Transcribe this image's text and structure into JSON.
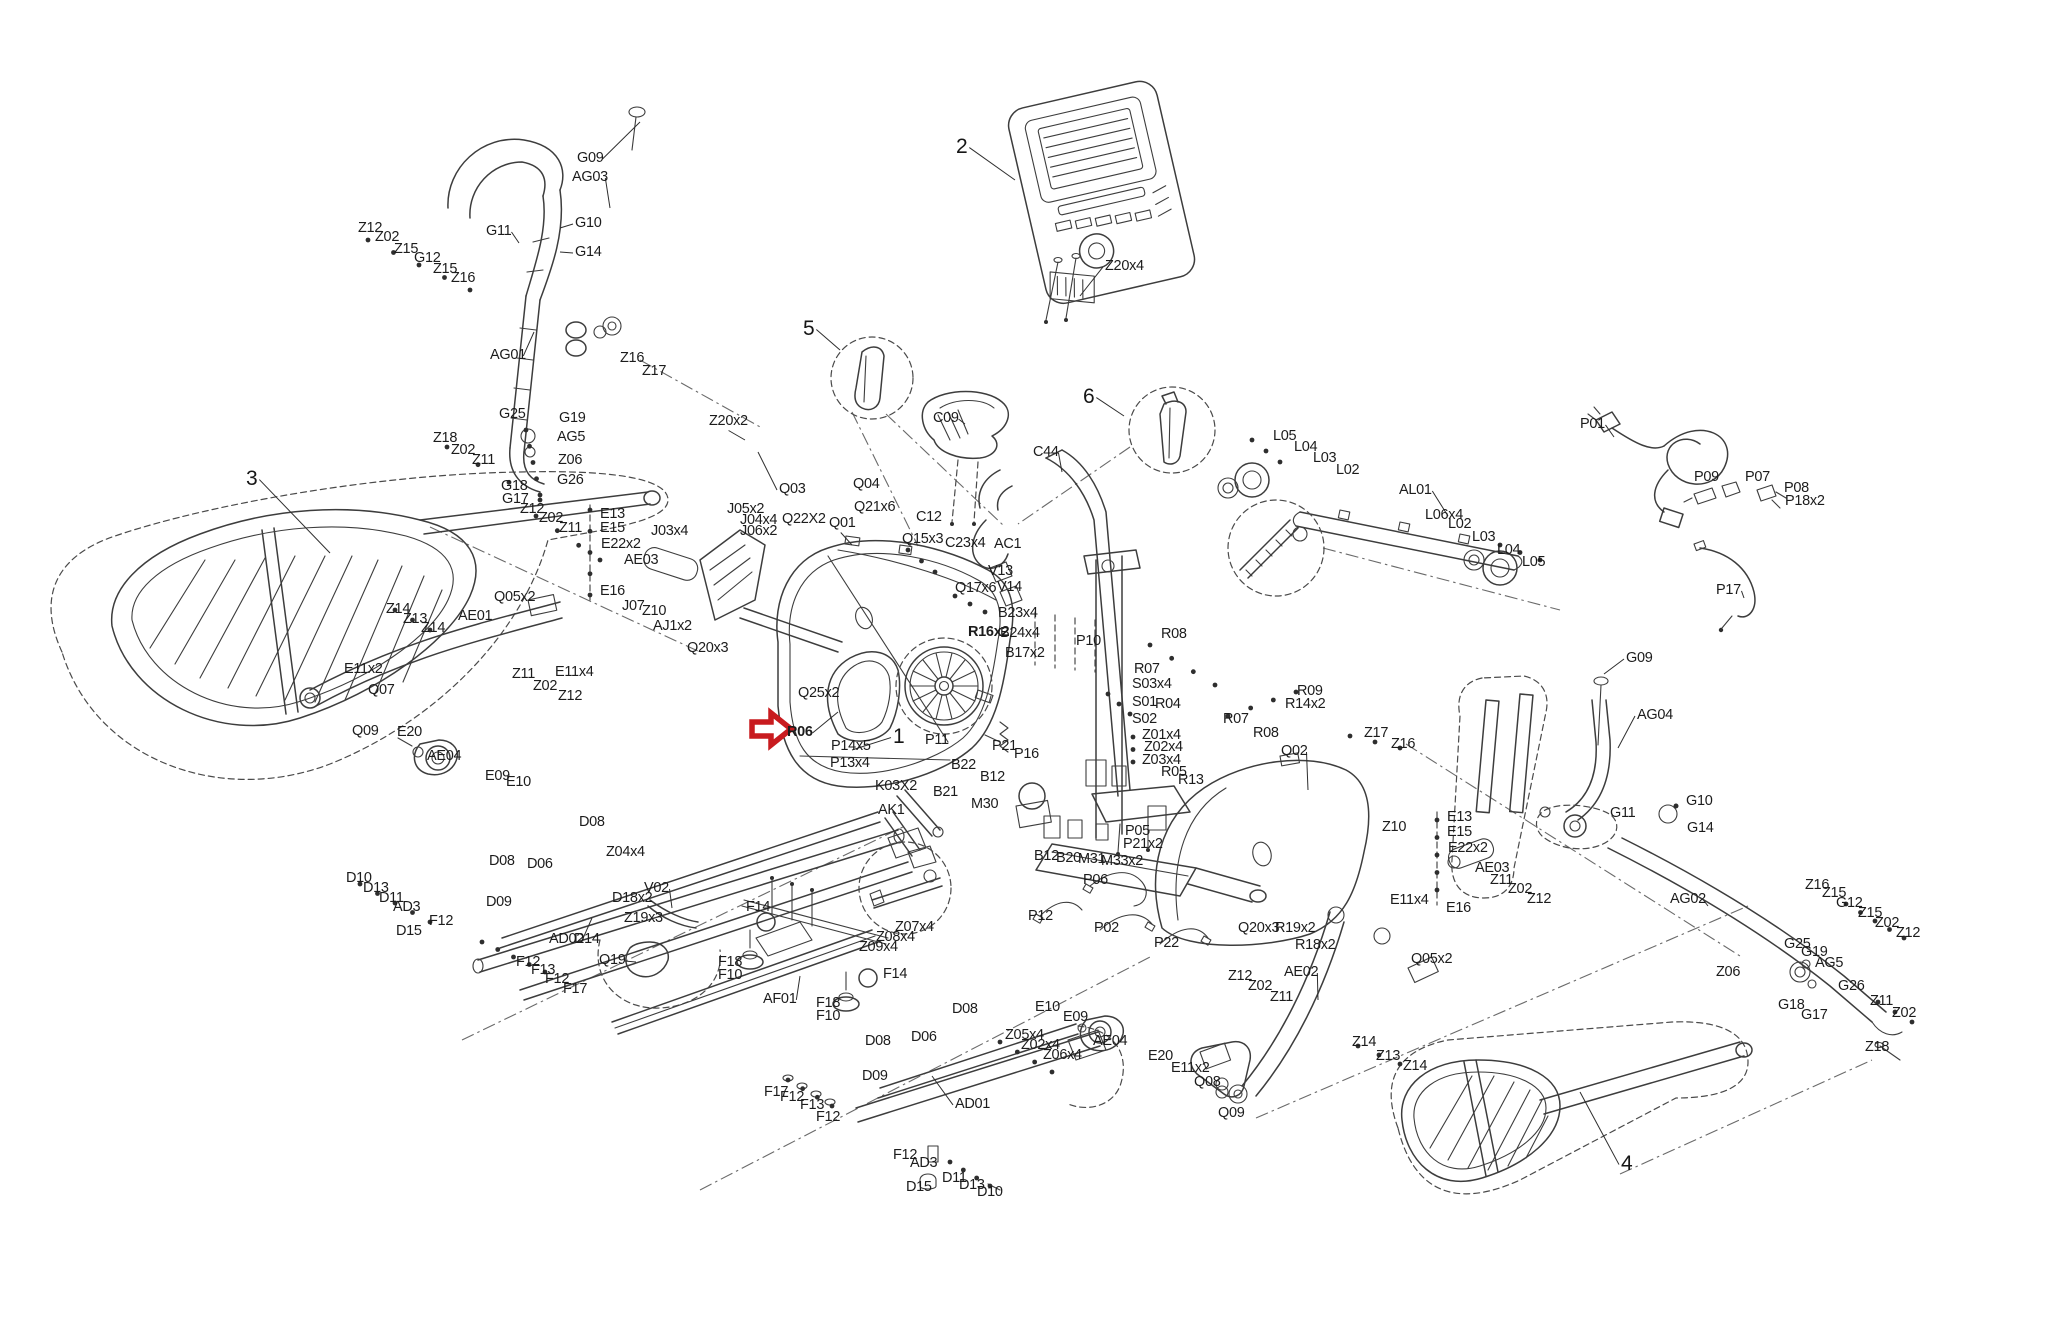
{
  "meta": {
    "figure": "elliptical-trainer-exploded-parts-diagram",
    "background": "#ffffff",
    "ink_color": "#3d3d3d",
    "text_color": "#1c1c1c",
    "highlight_color": "#c81b1f"
  },
  "red_arrow": {
    "label": "R06",
    "x": 752,
    "y": 712,
    "points": "752,722 771,722 771,713 791,729 771,745 771,736 752,736"
  },
  "callouts": [
    {
      "t": "1",
      "x": 893,
      "y": 726,
      "l": [
        852,
        750
      ]
    },
    {
      "t": "2",
      "x": 956,
      "y": 136,
      "l": [
        1015,
        180
      ]
    },
    {
      "t": "3",
      "x": 246,
      "y": 468,
      "l": [
        330,
        553
      ]
    },
    {
      "t": "4",
      "x": 1621,
      "y": 1153,
      "l": [
        1580,
        1092
      ]
    },
    {
      "t": "5",
      "x": 803,
      "y": 318,
      "l": [
        840,
        350
      ]
    },
    {
      "t": "6",
      "x": 1083,
      "y": 386,
      "l": [
        1124,
        416
      ]
    }
  ],
  "labels": [
    {
      "t": "G09",
      "x": 577,
      "y": 151,
      "l": [
        640,
        122
      ]
    },
    {
      "t": "AG03",
      "x": 572,
      "y": 170,
      "l": [
        610,
        208
      ]
    },
    {
      "t": "G11",
      "x": 486,
      "y": 224,
      "l": [
        519,
        243
      ]
    },
    {
      "t": "G10",
      "x": 575,
      "y": 216,
      "l": [
        560,
        228
      ]
    },
    {
      "t": "G14",
      "x": 575,
      "y": 245,
      "l": [
        560,
        252
      ]
    },
    {
      "t": "Z12",
      "x": 358,
      "y": 221
    },
    {
      "t": "Z02",
      "x": 375,
      "y": 230
    },
    {
      "t": "Z15",
      "x": 394,
      "y": 242
    },
    {
      "t": "G12",
      "x": 414,
      "y": 251
    },
    {
      "t": "Z15",
      "x": 433,
      "y": 262
    },
    {
      "t": "Z16",
      "x": 451,
      "y": 271
    },
    {
      "t": "AG01",
      "x": 490,
      "y": 348,
      "l": [
        534,
        332
      ]
    },
    {
      "t": "Z16",
      "x": 620,
      "y": 351
    },
    {
      "t": "Z17",
      "x": 642,
      "y": 364
    },
    {
      "t": "Z18",
      "x": 433,
      "y": 431
    },
    {
      "t": "Z02",
      "x": 451,
      "y": 443
    },
    {
      "t": "Z11",
      "x": 472,
      "y": 453
    },
    {
      "t": "G25",
      "x": 499,
      "y": 407
    },
    {
      "t": "G19",
      "x": 559,
      "y": 411
    },
    {
      "t": "AG5",
      "x": 557,
      "y": 430
    },
    {
      "t": "Z06",
      "x": 558,
      "y": 453
    },
    {
      "t": "G26",
      "x": 557,
      "y": 473
    },
    {
      "t": "G18",
      "x": 501,
      "y": 479
    },
    {
      "t": "G17",
      "x": 502,
      "y": 492
    },
    {
      "t": "Z20x2",
      "x": 709,
      "y": 414,
      "l": [
        745,
        440
      ]
    },
    {
      "t": "Q03",
      "x": 779,
      "y": 482,
      "l": [
        758,
        452
      ]
    },
    {
      "t": "Z12",
      "x": 520,
      "y": 502
    },
    {
      "t": "Z02",
      "x": 539,
      "y": 511
    },
    {
      "t": "Z11",
      "x": 559,
      "y": 521
    },
    {
      "t": "E13",
      "x": 600,
      "y": 507
    },
    {
      "t": "E15",
      "x": 600,
      "y": 521
    },
    {
      "t": "E22x2",
      "x": 601,
      "y": 537
    },
    {
      "t": "AE03",
      "x": 624,
      "y": 553
    },
    {
      "t": "E16",
      "x": 600,
      "y": 584
    },
    {
      "t": "J03x4",
      "x": 651,
      "y": 524
    },
    {
      "t": "J07",
      "x": 622,
      "y": 599
    },
    {
      "t": "Z10",
      "x": 642,
      "y": 604
    },
    {
      "t": "AJ1x2",
      "x": 653,
      "y": 619
    },
    {
      "t": "J05x2",
      "x": 727,
      "y": 502
    },
    {
      "t": "J04x4",
      "x": 740,
      "y": 513
    },
    {
      "t": "J06x2",
      "x": 740,
      "y": 524
    },
    {
      "t": "Q22X2",
      "x": 782,
      "y": 512
    },
    {
      "t": "Q01",
      "x": 829,
      "y": 516,
      "l": [
        852,
        545
      ]
    },
    {
      "t": "Q21x6",
      "x": 854,
      "y": 500
    },
    {
      "t": "Q15x3",
      "x": 902,
      "y": 532
    },
    {
      "t": "C12",
      "x": 916,
      "y": 510
    },
    {
      "t": "C23x4",
      "x": 945,
      "y": 536
    },
    {
      "t": "AC1",
      "x": 994,
      "y": 537
    },
    {
      "t": "V13",
      "x": 988,
      "y": 564
    },
    {
      "t": "V14",
      "x": 997,
      "y": 580
    },
    {
      "t": "Q17x6",
      "x": 955,
      "y": 581
    },
    {
      "t": "Q04",
      "x": 853,
      "y": 477
    },
    {
      "t": "C09",
      "x": 933,
      "y": 411,
      "l": [
        965,
        424
      ]
    },
    {
      "t": "C44",
      "x": 1033,
      "y": 445,
      "l": [
        1062,
        472
      ]
    },
    {
      "t": "Z20x4",
      "x": 1105,
      "y": 259,
      "l": [
        1080,
        296
      ]
    },
    {
      "t": "Z14",
      "x": 386,
      "y": 602
    },
    {
      "t": "Z13",
      "x": 403,
      "y": 612
    },
    {
      "t": "Z14",
      "x": 421,
      "y": 621
    },
    {
      "t": "E11x2",
      "x": 344,
      "y": 662
    },
    {
      "t": "Q07",
      "x": 368,
      "y": 683
    },
    {
      "t": "Q09",
      "x": 352,
      "y": 724
    },
    {
      "t": "E20",
      "x": 397,
      "y": 725
    },
    {
      "t": "AE04",
      "x": 427,
      "y": 749
    },
    {
      "t": "E09",
      "x": 485,
      "y": 769
    },
    {
      "t": "E10",
      "x": 506,
      "y": 775
    },
    {
      "t": "AE01",
      "x": 458,
      "y": 609
    },
    {
      "t": "Q05x2",
      "x": 494,
      "y": 590
    },
    {
      "t": "Z11",
      "x": 512,
      "y": 667
    },
    {
      "t": "Z02",
      "x": 533,
      "y": 679
    },
    {
      "t": "Z12",
      "x": 558,
      "y": 689
    },
    {
      "t": "E11x4",
      "x": 555,
      "y": 665
    },
    {
      "t": "Q20x3",
      "x": 687,
      "y": 641
    },
    {
      "t": "Q25x2",
      "x": 798,
      "y": 686
    },
    {
      "t": "R06",
      "x": 787,
      "y": 725,
      "b": 1,
      "l": [
        838,
        712
      ]
    },
    {
      "t": "P14x5",
      "x": 831,
      "y": 739
    },
    {
      "t": "P13x4",
      "x": 830,
      "y": 756
    },
    {
      "t": "P11",
      "x": 925,
      "y": 733
    },
    {
      "t": "K03X2",
      "x": 875,
      "y": 779
    },
    {
      "t": "AK1",
      "x": 878,
      "y": 803
    },
    {
      "t": "B22",
      "x": 951,
      "y": 758
    },
    {
      "t": "B21",
      "x": 933,
      "y": 785
    },
    {
      "t": "B12",
      "x": 980,
      "y": 770
    },
    {
      "t": "M30",
      "x": 971,
      "y": 797
    },
    {
      "t": "B12",
      "x": 1034,
      "y": 849
    },
    {
      "t": "B20",
      "x": 1056,
      "y": 851
    },
    {
      "t": "M31",
      "x": 1078,
      "y": 852
    },
    {
      "t": "M33x2",
      "x": 1101,
      "y": 854
    },
    {
      "t": "P05",
      "x": 1125,
      "y": 824
    },
    {
      "t": "P21x2",
      "x": 1123,
      "y": 837
    },
    {
      "t": "P21",
      "x": 992,
      "y": 739
    },
    {
      "t": "P16",
      "x": 1014,
      "y": 747
    },
    {
      "t": "B23x4",
      "x": 998,
      "y": 606
    },
    {
      "t": "R16x2",
      "x": 968,
      "y": 625,
      "b": 1
    },
    {
      "t": "B24x4",
      "x": 1000,
      "y": 626
    },
    {
      "t": "B17x2",
      "x": 1005,
      "y": 646
    },
    {
      "t": "P10",
      "x": 1076,
      "y": 634
    },
    {
      "t": "R08",
      "x": 1161,
      "y": 627
    },
    {
      "t": "R07",
      "x": 1134,
      "y": 662
    },
    {
      "t": "S03x4",
      "x": 1132,
      "y": 677
    },
    {
      "t": "S01",
      "x": 1132,
      "y": 695
    },
    {
      "t": "R04",
      "x": 1155,
      "y": 697
    },
    {
      "t": "S02",
      "x": 1132,
      "y": 712
    },
    {
      "t": "Z01x4",
      "x": 1142,
      "y": 728
    },
    {
      "t": "Z02x4",
      "x": 1144,
      "y": 740
    },
    {
      "t": "Z03x4",
      "x": 1142,
      "y": 753
    },
    {
      "t": "R05",
      "x": 1161,
      "y": 765
    },
    {
      "t": "R13",
      "x": 1178,
      "y": 773
    },
    {
      "t": "R09",
      "x": 1297,
      "y": 684
    },
    {
      "t": "R14x2",
      "x": 1285,
      "y": 697
    },
    {
      "t": "R07",
      "x": 1223,
      "y": 712
    },
    {
      "t": "R08",
      "x": 1253,
      "y": 726
    },
    {
      "t": "Q02",
      "x": 1281,
      "y": 744,
      "l": [
        1308,
        790
      ]
    },
    {
      "t": "Z17",
      "x": 1364,
      "y": 726
    },
    {
      "t": "Z16",
      "x": 1391,
      "y": 737
    },
    {
      "t": "L05",
      "x": 1273,
      "y": 429
    },
    {
      "t": "L04",
      "x": 1294,
      "y": 440
    },
    {
      "t": "L03",
      "x": 1313,
      "y": 451
    },
    {
      "t": "L02",
      "x": 1336,
      "y": 463
    },
    {
      "t": "AL01",
      "x": 1399,
      "y": 483,
      "l": [
        1448,
        516
      ]
    },
    {
      "t": "L06x4",
      "x": 1425,
      "y": 508
    },
    {
      "t": "L02",
      "x": 1448,
      "y": 517
    },
    {
      "t": "L03",
      "x": 1472,
      "y": 530
    },
    {
      "t": "L04",
      "x": 1497,
      "y": 543
    },
    {
      "t": "L05",
      "x": 1522,
      "y": 555
    },
    {
      "t": "P01",
      "x": 1580,
      "y": 417,
      "l": [
        1614,
        437
      ]
    },
    {
      "t": "P09",
      "x": 1694,
      "y": 470
    },
    {
      "t": "P07",
      "x": 1745,
      "y": 470
    },
    {
      "t": "P08",
      "x": 1784,
      "y": 481
    },
    {
      "t": "P18x2",
      "x": 1785,
      "y": 494
    },
    {
      "t": "P17",
      "x": 1716,
      "y": 583,
      "l": [
        1744,
        598
      ]
    },
    {
      "t": "G09",
      "x": 1626,
      "y": 651,
      "l": [
        1604,
        674
      ]
    },
    {
      "t": "AG04",
      "x": 1637,
      "y": 708,
      "l": [
        1618,
        748
      ]
    },
    {
      "t": "G10",
      "x": 1686,
      "y": 794
    },
    {
      "t": "G11",
      "x": 1610,
      "y": 806
    },
    {
      "t": "G14",
      "x": 1687,
      "y": 821
    },
    {
      "t": "AG02",
      "x": 1670,
      "y": 892,
      "l": [
        1708,
        906
      ]
    },
    {
      "t": "Z16",
      "x": 1805,
      "y": 878
    },
    {
      "t": "Z15",
      "x": 1822,
      "y": 886
    },
    {
      "t": "G12",
      "x": 1836,
      "y": 896
    },
    {
      "t": "Z15",
      "x": 1858,
      "y": 906
    },
    {
      "t": "Z02",
      "x": 1875,
      "y": 916
    },
    {
      "t": "Z12",
      "x": 1896,
      "y": 926
    },
    {
      "t": "G25",
      "x": 1784,
      "y": 937
    },
    {
      "t": "G19",
      "x": 1801,
      "y": 945
    },
    {
      "t": "AG5",
      "x": 1815,
      "y": 956
    },
    {
      "t": "G26",
      "x": 1838,
      "y": 979
    },
    {
      "t": "G18",
      "x": 1778,
      "y": 998
    },
    {
      "t": "G17",
      "x": 1801,
      "y": 1008
    },
    {
      "t": "Z11",
      "x": 1870,
      "y": 994
    },
    {
      "t": "Z02",
      "x": 1892,
      "y": 1006
    },
    {
      "t": "Z18",
      "x": 1865,
      "y": 1040
    },
    {
      "t": "Z06",
      "x": 1716,
      "y": 965
    },
    {
      "t": "Z14",
      "x": 1352,
      "y": 1035
    },
    {
      "t": "Z13",
      "x": 1376,
      "y": 1049
    },
    {
      "t": "Z14",
      "x": 1403,
      "y": 1059
    },
    {
      "t": "Q05x2",
      "x": 1411,
      "y": 952
    },
    {
      "t": "AE02",
      "x": 1284,
      "y": 965,
      "l": [
        1318,
        1000
      ]
    },
    {
      "t": "Z12",
      "x": 1228,
      "y": 969
    },
    {
      "t": "Z02",
      "x": 1248,
      "y": 979
    },
    {
      "t": "Z11",
      "x": 1270,
      "y": 990
    },
    {
      "t": "E11x4",
      "x": 1390,
      "y": 893
    },
    {
      "t": "E16",
      "x": 1446,
      "y": 901
    },
    {
      "t": "E13",
      "x": 1447,
      "y": 810
    },
    {
      "t": "E15",
      "x": 1447,
      "y": 825
    },
    {
      "t": "E22x2",
      "x": 1448,
      "y": 841
    },
    {
      "t": "AE03",
      "x": 1475,
      "y": 861
    },
    {
      "t": "Z11",
      "x": 1490,
      "y": 873
    },
    {
      "t": "Z02",
      "x": 1508,
      "y": 882
    },
    {
      "t": "Z12",
      "x": 1527,
      "y": 892
    },
    {
      "t": "Z10",
      "x": 1382,
      "y": 820
    },
    {
      "t": "Q20x3",
      "x": 1238,
      "y": 921
    },
    {
      "t": "R19x2",
      "x": 1275,
      "y": 921
    },
    {
      "t": "R18x2",
      "x": 1295,
      "y": 938
    },
    {
      "t": "E10",
      "x": 1035,
      "y": 1000
    },
    {
      "t": "E09",
      "x": 1063,
      "y": 1010
    },
    {
      "t": "AE04",
      "x": 1093,
      "y": 1034
    },
    {
      "t": "E20",
      "x": 1148,
      "y": 1049
    },
    {
      "t": "E11x2",
      "x": 1171,
      "y": 1061
    },
    {
      "t": "Q08",
      "x": 1194,
      "y": 1075
    },
    {
      "t": "Q09",
      "x": 1218,
      "y": 1106
    },
    {
      "t": "P06",
      "x": 1083,
      "y": 873
    },
    {
      "t": "P02",
      "x": 1094,
      "y": 921
    },
    {
      "t": "P22",
      "x": 1154,
      "y": 936
    },
    {
      "t": "P12",
      "x": 1028,
      "y": 909
    },
    {
      "t": "D08",
      "x": 579,
      "y": 815
    },
    {
      "t": "D06",
      "x": 527,
      "y": 857
    },
    {
      "t": "Z04x4",
      "x": 606,
      "y": 845
    },
    {
      "t": "D08",
      "x": 489,
      "y": 854
    },
    {
      "t": "D09",
      "x": 486,
      "y": 895
    },
    {
      "t": "D18x2",
      "x": 612,
      "y": 891
    },
    {
      "t": "V02",
      "x": 644,
      "y": 881,
      "l": [
        672,
        908
      ]
    },
    {
      "t": "Z19x3",
      "x": 624,
      "y": 911
    },
    {
      "t": "AD02",
      "x": 549,
      "y": 932,
      "l": [
        592,
        918
      ]
    },
    {
      "t": "D14",
      "x": 574,
      "y": 932
    },
    {
      "t": "Q19",
      "x": 599,
      "y": 953,
      "l": [
        636,
        962
      ]
    },
    {
      "t": "D10",
      "x": 346,
      "y": 871
    },
    {
      "t": "D13",
      "x": 363,
      "y": 881
    },
    {
      "t": "D11",
      "x": 379,
      "y": 891
    },
    {
      "t": "AD3",
      "x": 393,
      "y": 900
    },
    {
      "t": "F12",
      "x": 429,
      "y": 914
    },
    {
      "t": "D15",
      "x": 396,
      "y": 924
    },
    {
      "t": "F12",
      "x": 516,
      "y": 955
    },
    {
      "t": "F13",
      "x": 531,
      "y": 963
    },
    {
      "t": "F12",
      "x": 545,
      "y": 972
    },
    {
      "t": "F17",
      "x": 563,
      "y": 982
    },
    {
      "t": "F14",
      "x": 746,
      "y": 900
    },
    {
      "t": "F18",
      "x": 718,
      "y": 955
    },
    {
      "t": "F10",
      "x": 718,
      "y": 968
    },
    {
      "t": "AF01",
      "x": 763,
      "y": 992,
      "l": [
        800,
        976
      ]
    },
    {
      "t": "F18",
      "x": 816,
      "y": 996
    },
    {
      "t": "F10",
      "x": 816,
      "y": 1009
    },
    {
      "t": "F14",
      "x": 883,
      "y": 967
    },
    {
      "t": "Z07x4",
      "x": 895,
      "y": 920
    },
    {
      "t": "Z08x4",
      "x": 876,
      "y": 930
    },
    {
      "t": "Z09x4",
      "x": 859,
      "y": 940
    },
    {
      "t": "D08",
      "x": 952,
      "y": 1002
    },
    {
      "t": "D06",
      "x": 911,
      "y": 1030
    },
    {
      "t": "D08",
      "x": 865,
      "y": 1034
    },
    {
      "t": "D09",
      "x": 862,
      "y": 1069
    },
    {
      "t": "Z05x4",
      "x": 1005,
      "y": 1028
    },
    {
      "t": "Z02x4",
      "x": 1021,
      "y": 1038
    },
    {
      "t": "Z06x4",
      "x": 1043,
      "y": 1048
    },
    {
      "t": "AD01",
      "x": 955,
      "y": 1097,
      "l": [
        932,
        1076
      ]
    },
    {
      "t": "F17",
      "x": 764,
      "y": 1085
    },
    {
      "t": "F12",
      "x": 780,
      "y": 1090
    },
    {
      "t": "F13",
      "x": 800,
      "y": 1098
    },
    {
      "t": "F12",
      "x": 816,
      "y": 1110
    },
    {
      "t": "F12",
      "x": 893,
      "y": 1148
    },
    {
      "t": "AD3",
      "x": 910,
      "y": 1156
    },
    {
      "t": "D15",
      "x": 906,
      "y": 1180
    },
    {
      "t": "D11",
      "x": 942,
      "y": 1171
    },
    {
      "t": "D13",
      "x": 959,
      "y": 1178
    },
    {
      "t": "D10",
      "x": 977,
      "y": 1185
    }
  ]
}
